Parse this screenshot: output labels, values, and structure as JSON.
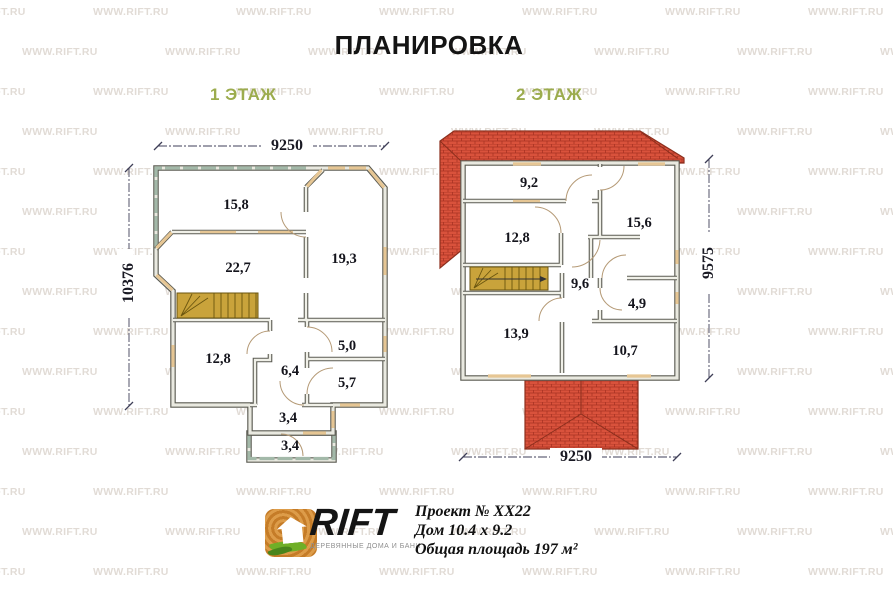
{
  "title": "ПЛАНИРОВКА",
  "floor1": {
    "label": "1 ЭТАЖ",
    "dim_width": "9250",
    "dim_height": "10376",
    "rooms": [
      {
        "area": "15,8"
      },
      {
        "area": "22,7"
      },
      {
        "area": "19,3"
      },
      {
        "area": "12,8"
      },
      {
        "area": "6,4"
      },
      {
        "area": "5,0"
      },
      {
        "area": "5,7"
      },
      {
        "area": "3,4"
      },
      {
        "area": "3,4"
      }
    ]
  },
  "floor2": {
    "label": "2 ЭТАЖ",
    "dim_width": "9250",
    "dim_height": "9575",
    "rooms": [
      {
        "area": "9,2"
      },
      {
        "area": "12,8"
      },
      {
        "area": "15,6"
      },
      {
        "area": "9,6"
      },
      {
        "area": "4,9"
      },
      {
        "area": "13,9"
      },
      {
        "area": "10,7"
      }
    ]
  },
  "footer": {
    "brand": "RIFT",
    "brand_tagline": "ДЕРЕВЯННЫЕ ДОМА И БАНИ",
    "project": "Проект № ХХ22",
    "house": "Дом 10.4 х 9.2",
    "area_total": "Общая площадь 197 м²"
  },
  "watermark": {
    "text": "WWW.RIFT.RU"
  },
  "colors": {
    "floor_label_green": "#9cac4e",
    "wall_dark": "#5b5b52",
    "wall_light": "#e9e9e0",
    "window_tan": "#e6c694",
    "terrace_green": "#a3b9a9",
    "stair_gold": "#c9a33b",
    "roof_red": "#d9523c",
    "roof_line": "#a83222",
    "dim_blue": "#3f3f58",
    "watermark_gray": "#c9beb4"
  }
}
